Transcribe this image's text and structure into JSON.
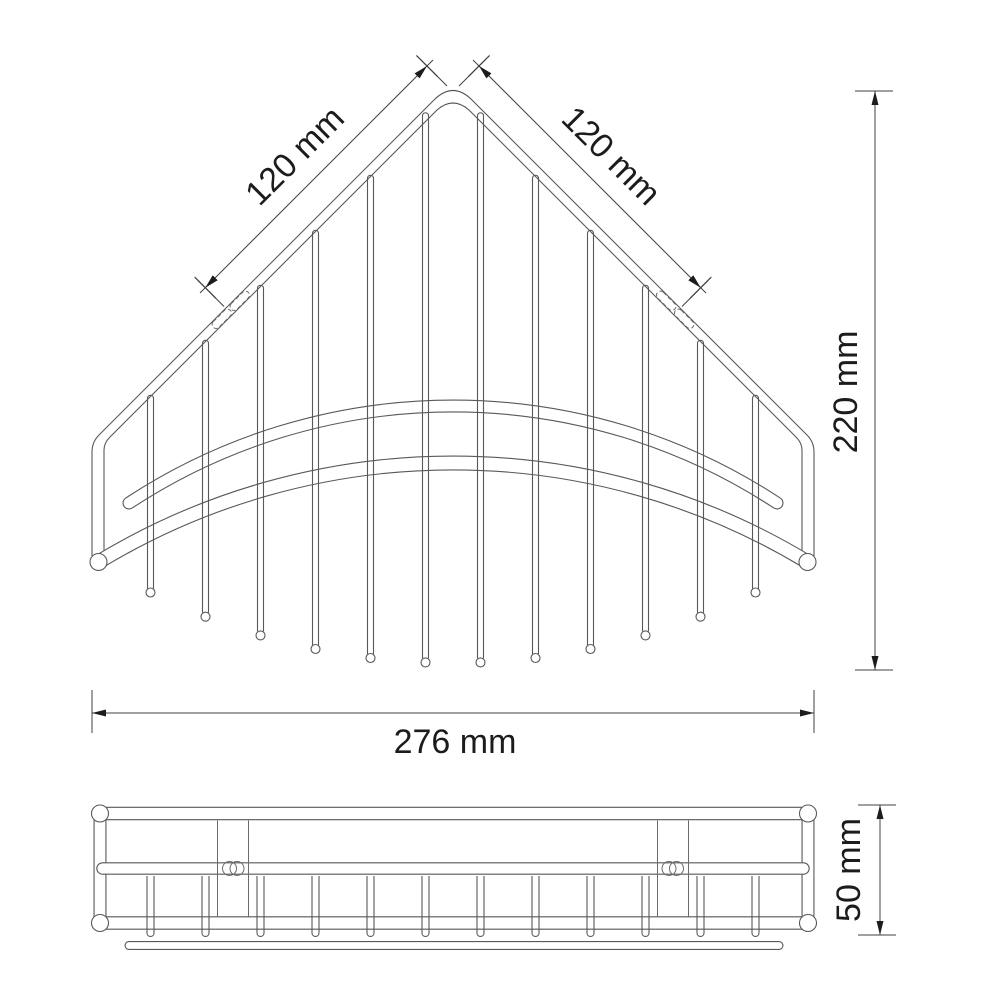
{
  "drawing": {
    "kind": "technical dimension drawing",
    "subject": "corner wire basket shelf, two orthographic views",
    "background": "#ffffff",
    "line_color": "#585858",
    "dimension_color": "#404040",
    "text_color": "#1c1c1c",
    "views": {
      "top_view": {
        "wire_count": 12,
        "mounting_slot_count": 4,
        "has_front_rail": true
      },
      "front_view": {
        "wire_count": 12,
        "bracket_count": 2,
        "screw_pair_count": 2
      }
    },
    "dimensions": {
      "edge_left": {
        "label": "120 mm",
        "value_mm": 120
      },
      "edge_right": {
        "label": "120 mm",
        "value_mm": 120
      },
      "depth": {
        "label": "220 mm",
        "value_mm": 220
      },
      "width": {
        "label": "276 mm",
        "value_mm": 276
      },
      "height": {
        "label": "50 mm",
        "value_mm": 50
      }
    }
  }
}
